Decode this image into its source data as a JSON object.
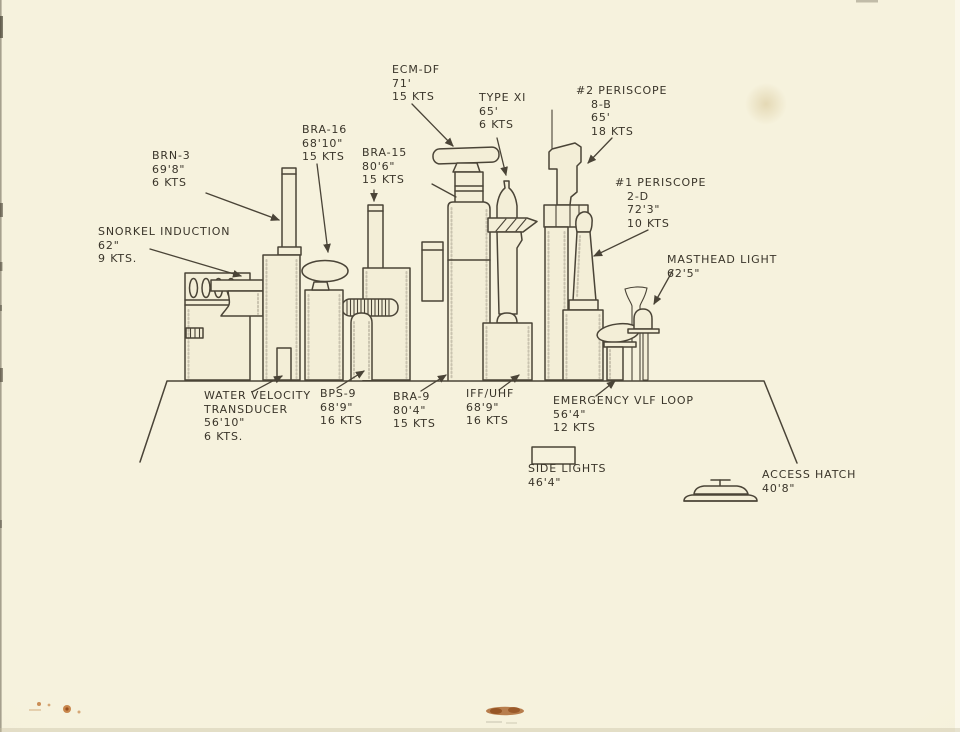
{
  "colors": {
    "paper": "#f3efd9",
    "ink": "#4a4437",
    "pencil_text": "#3a352a",
    "stain_tan": "#d6c494",
    "stain_rust": "#a85f28"
  },
  "labels": {
    "ecm_df": {
      "lines": [
        "ECM-DF",
        "71'",
        "15 KTS"
      ]
    },
    "type_xi": {
      "lines": [
        "TYPE XI",
        "65'",
        "6 KTS"
      ]
    },
    "periscope2": {
      "lines": [
        "#2 PERISCOPE",
        "8-B",
        "65'",
        "18 KTS"
      ]
    },
    "bra16": {
      "lines": [
        "BRA-16",
        "68'10\"",
        "15 KTS"
      ]
    },
    "bra15": {
      "lines": [
        "BRA-15",
        "80'6\"",
        "15 KTS"
      ]
    },
    "brn3": {
      "lines": [
        "BRN-3",
        "69'8\"",
        "6 KTS"
      ]
    },
    "periscope1": {
      "lines": [
        "#1 PERISCOPE",
        "2-D",
        "72'3\"",
        "10 KTS"
      ]
    },
    "snorkel": {
      "lines": [
        "SNORKEL INDUCTION",
        "62\"",
        "9 KTS."
      ]
    },
    "masthead": {
      "lines": [
        "MASTHEAD LIGHT",
        "62'5\""
      ]
    },
    "water_velocity": {
      "lines": [
        "WATER VELOCITY",
        "TRANSDUCER",
        "56'10\"",
        "6 KTS."
      ]
    },
    "bps9": {
      "lines": [
        "BPS-9",
        "68'9\"",
        "16 KTS"
      ]
    },
    "bra9": {
      "lines": [
        "BRA-9",
        "80'4\"",
        "15 KTS"
      ]
    },
    "iff_uhf": {
      "lines": [
        "IFF/UHF",
        "68'9\"",
        "16 KTS"
      ]
    },
    "vlf_loop": {
      "lines": [
        "EMERGENCY VLF LOOP",
        "56'4\"",
        "12 KTS"
      ]
    },
    "side_lights": {
      "lines": [
        "SIDE LIGHTS",
        "46'4\""
      ]
    },
    "access_hatch": {
      "lines": [
        "ACCESS HATCH",
        "40'8\""
      ]
    }
  }
}
